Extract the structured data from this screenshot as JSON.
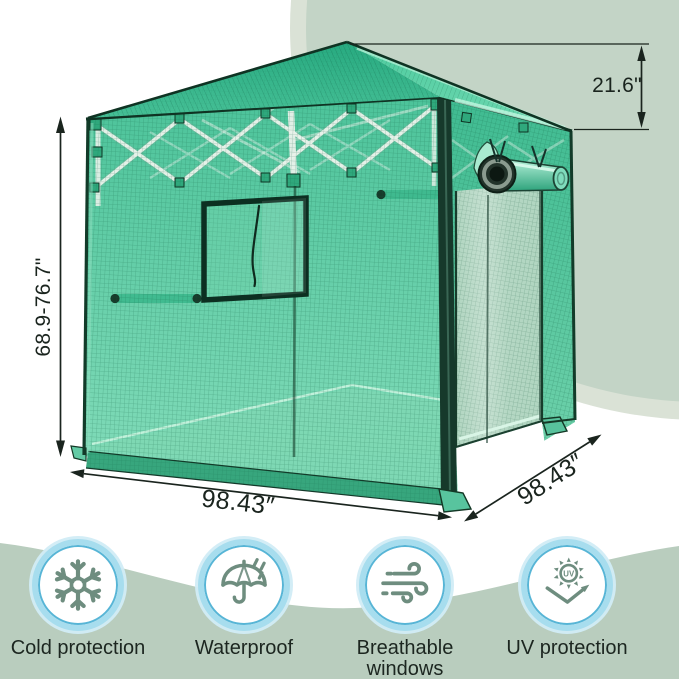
{
  "dimensions": {
    "height_label": "68.9-76.7\"",
    "peak_label": "21.6\"",
    "width_label": "98.43″",
    "depth_label": "98.43″"
  },
  "features": {
    "uv_text": "UV",
    "items": [
      {
        "label": "Cold protection",
        "icon": "snowflake-icon"
      },
      {
        "label": "Waterproof",
        "icon": "umbrella-rain-icon"
      },
      {
        "label": "Breathable\nwindows",
        "icon": "wind-icon"
      },
      {
        "label": "UV protection",
        "icon": "uv-sun-icon"
      }
    ]
  },
  "colors": {
    "background_blob": "#c3d4c6",
    "background_blob_fringe": "#dae2d6",
    "wave_band": "#b9cdbe",
    "greenhouse_cover": "#55c8a0",
    "greenhouse_trim": "#123b29",
    "icon_ring": "#a7ddee",
    "icon_glyph": "#6e8d7f",
    "dimension_ink": "#1a241e"
  }
}
